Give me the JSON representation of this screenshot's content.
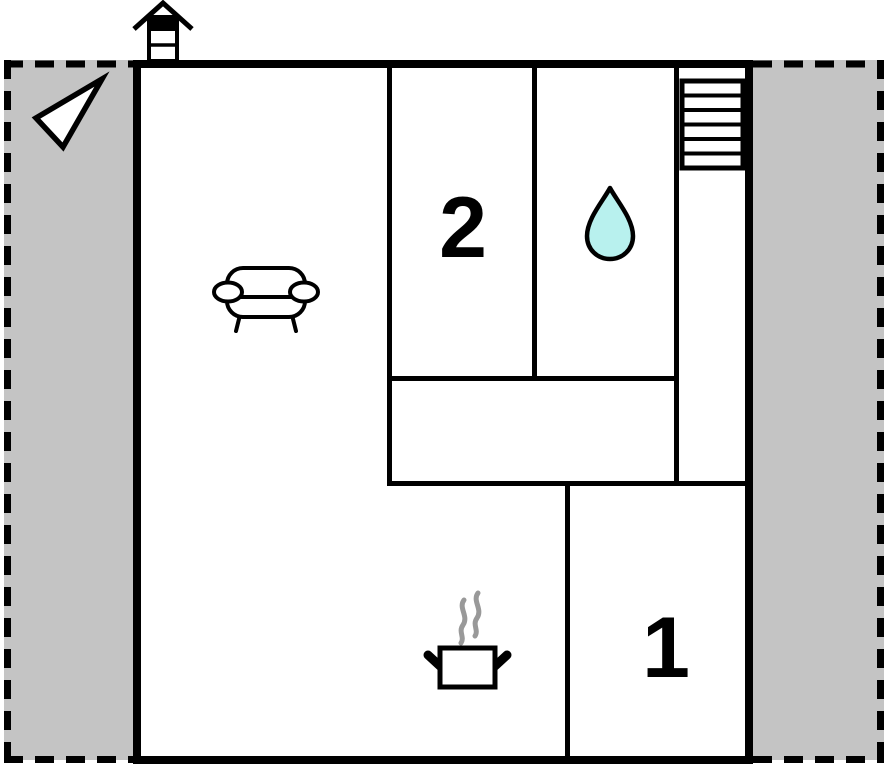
{
  "floorplan": {
    "room_labels": [
      {
        "value": "2"
      },
      {
        "value": "1"
      }
    ],
    "colors": {
      "wall": "#000000",
      "floor": "#ffffff",
      "outdoor_area": "#c4c4c4",
      "water_drop": "#b8f1ee",
      "steam": "#999999"
    },
    "icons": [
      {
        "name": "north-arrow-icon",
        "glyph": "outlined triangle arrow pointing lower-left"
      },
      {
        "name": "chimney-icon",
        "glyph": "gabled roof over banded flue"
      },
      {
        "name": "stairs-icon",
        "glyph": "rectangle with six treads"
      },
      {
        "name": "sofa-icon",
        "glyph": "two-seat sofa seen from above"
      },
      {
        "name": "water-drop-icon",
        "glyph": "teardrop"
      },
      {
        "name": "cooking-pot-icon",
        "glyph": "pot with two handles and rising steam"
      }
    ]
  }
}
